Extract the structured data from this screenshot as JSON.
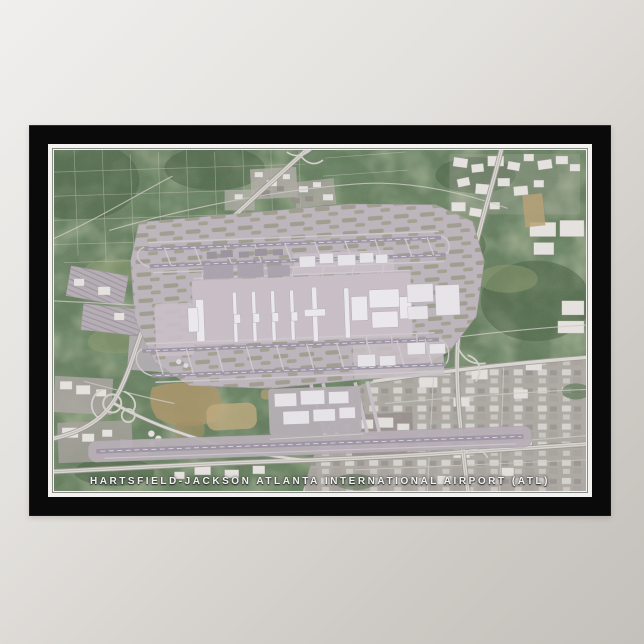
{
  "poster": {
    "caption": "HARTSFIELD-JACKSON ATLANTA INTERNATIONAL AIRPORT (ATL)",
    "image_type": "satellite-aerial-photograph",
    "subject": "Hartsfield-Jackson Atlanta International Airport seen from above, framed poster on a wall"
  },
  "colors": {
    "wall_light": "#f0efed",
    "wall_dark": "#c4c0bb",
    "frame_black": "#0a0a0a",
    "mat_white": "#f3f2ef",
    "mat_line": "#8a8a8a",
    "forest_green": "#5a7450",
    "forest_dark": "#3c5534",
    "forest_light": "#8d9c68",
    "airfield_pavement": "#bdb4ba",
    "runway_gray": "#9a91a0",
    "taxiway_light": "#d3cbd3",
    "terminal_white": "#f1eef2",
    "highway_fill": "#dcd9d4",
    "highway_casing": "#999389",
    "urban_gray": "#b1a9a4",
    "building_white": "#eae7e2",
    "dirt_tan": "#a8915f",
    "caption_text": "#f2f2f0"
  }
}
